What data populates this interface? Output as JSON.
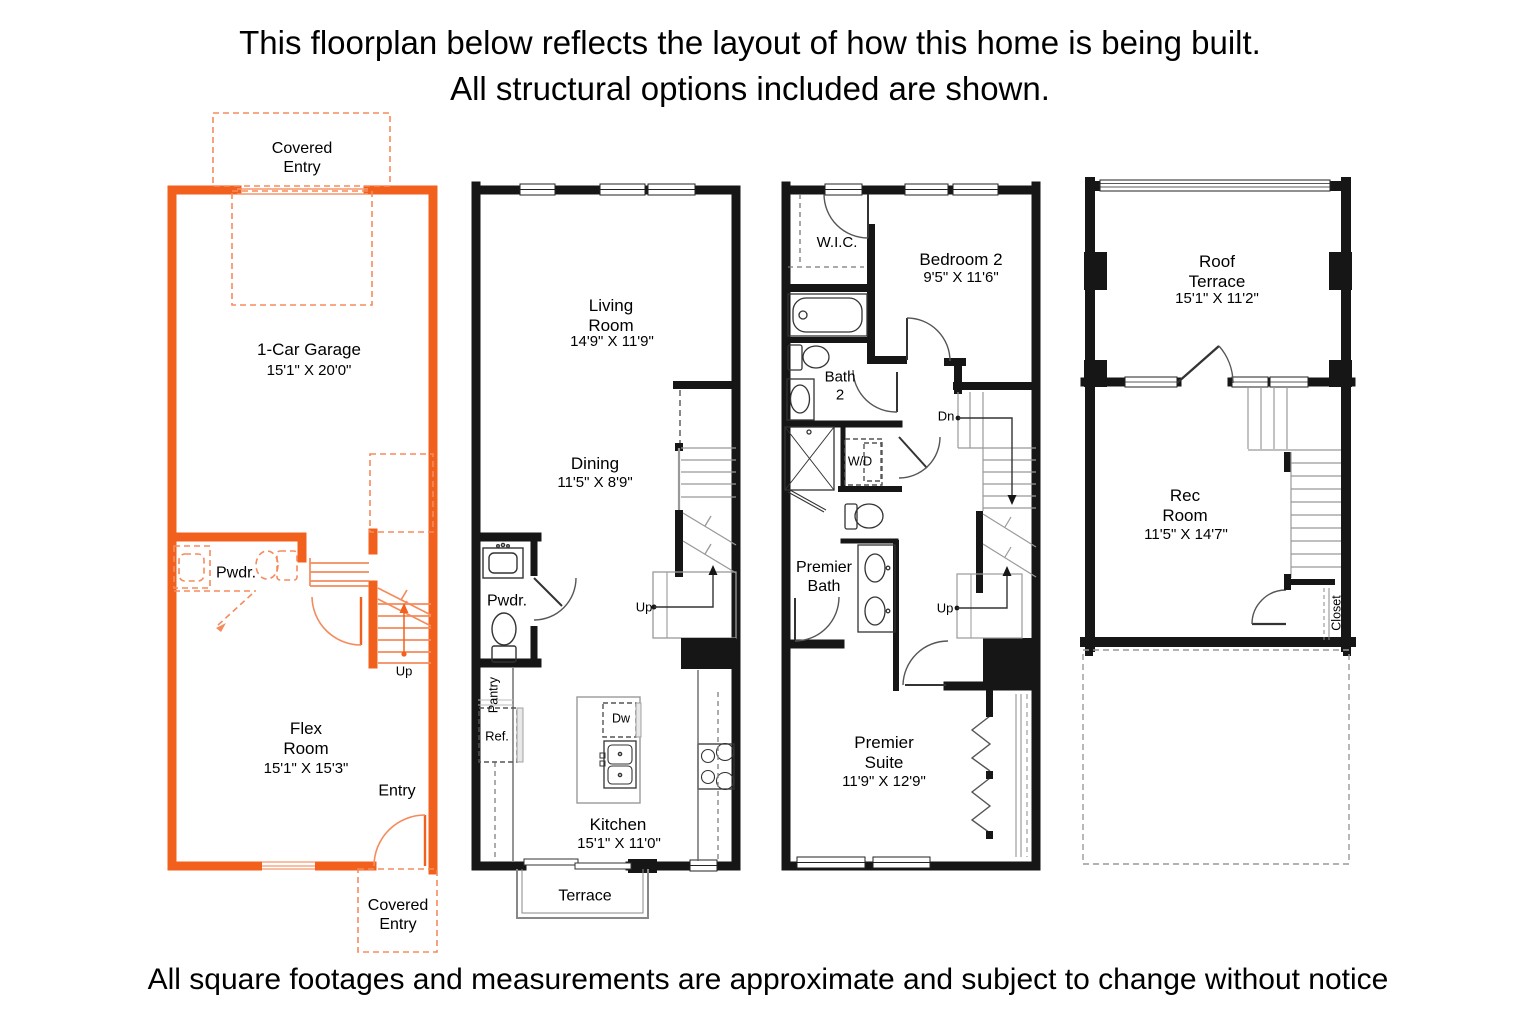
{
  "header": {
    "line1": "This floorplan below reflects the layout of how this home is being built.",
    "line2": "All structural options included are shown."
  },
  "footer": {
    "disclaimer": "All square footages and measurements are approximate and subject to change without notice"
  },
  "colors": {
    "accent_orange": "#F2601D",
    "light_orange": "#F58B5C",
    "wall_black": "#161616"
  },
  "floors": [
    {
      "id": "floor-1",
      "labels": {
        "covered_entry_top": "Covered\nEntry",
        "garage_name": "1-Car Garage",
        "garage_dims": "15'1\" X 20'0\"",
        "pwdr": "Pwdr.",
        "up": "Up",
        "flex_name": "Flex\nRoom",
        "flex_dims": "15'1\" X 15'3\"",
        "entry": "Entry",
        "covered_entry_bottom": "Covered\nEntry"
      }
    },
    {
      "id": "floor-2",
      "labels": {
        "living_name": "Living\nRoom",
        "living_dims": "14'9\" X 11'9\"",
        "dining_name": "Dining",
        "dining_dims": "11'5\" X 8'9\"",
        "pwdr": "Pwdr.",
        "up": "Up",
        "pantry": "Pantry",
        "ref": "Ref.",
        "dw": "Dw",
        "kitchen_name": "Kitchen",
        "kitchen_dims": "15'1\" X 11'0\"",
        "terrace": "Terrace"
      }
    },
    {
      "id": "floor-3",
      "labels": {
        "wic": "W.I.C.",
        "bedroom2_name": "Bedroom 2",
        "bedroom2_dims": "9'5\" X 11'6\"",
        "bath2": "Bath\n2",
        "dn": "Dn",
        "wd": "W/D",
        "premier_bath": "Premier\nBath",
        "up": "Up",
        "suite_name": "Premier\nSuite",
        "suite_dims": "11'9\" X 12'9\""
      }
    },
    {
      "id": "floor-4",
      "labels": {
        "roof_terrace_name": "Roof\nTerrace",
        "roof_terrace_dims": "15'1\" X 11'2\"",
        "rec_name": "Rec\nRoom",
        "rec_dims": "11'5\" X 14'7\"",
        "closet": "Closet"
      }
    }
  ]
}
